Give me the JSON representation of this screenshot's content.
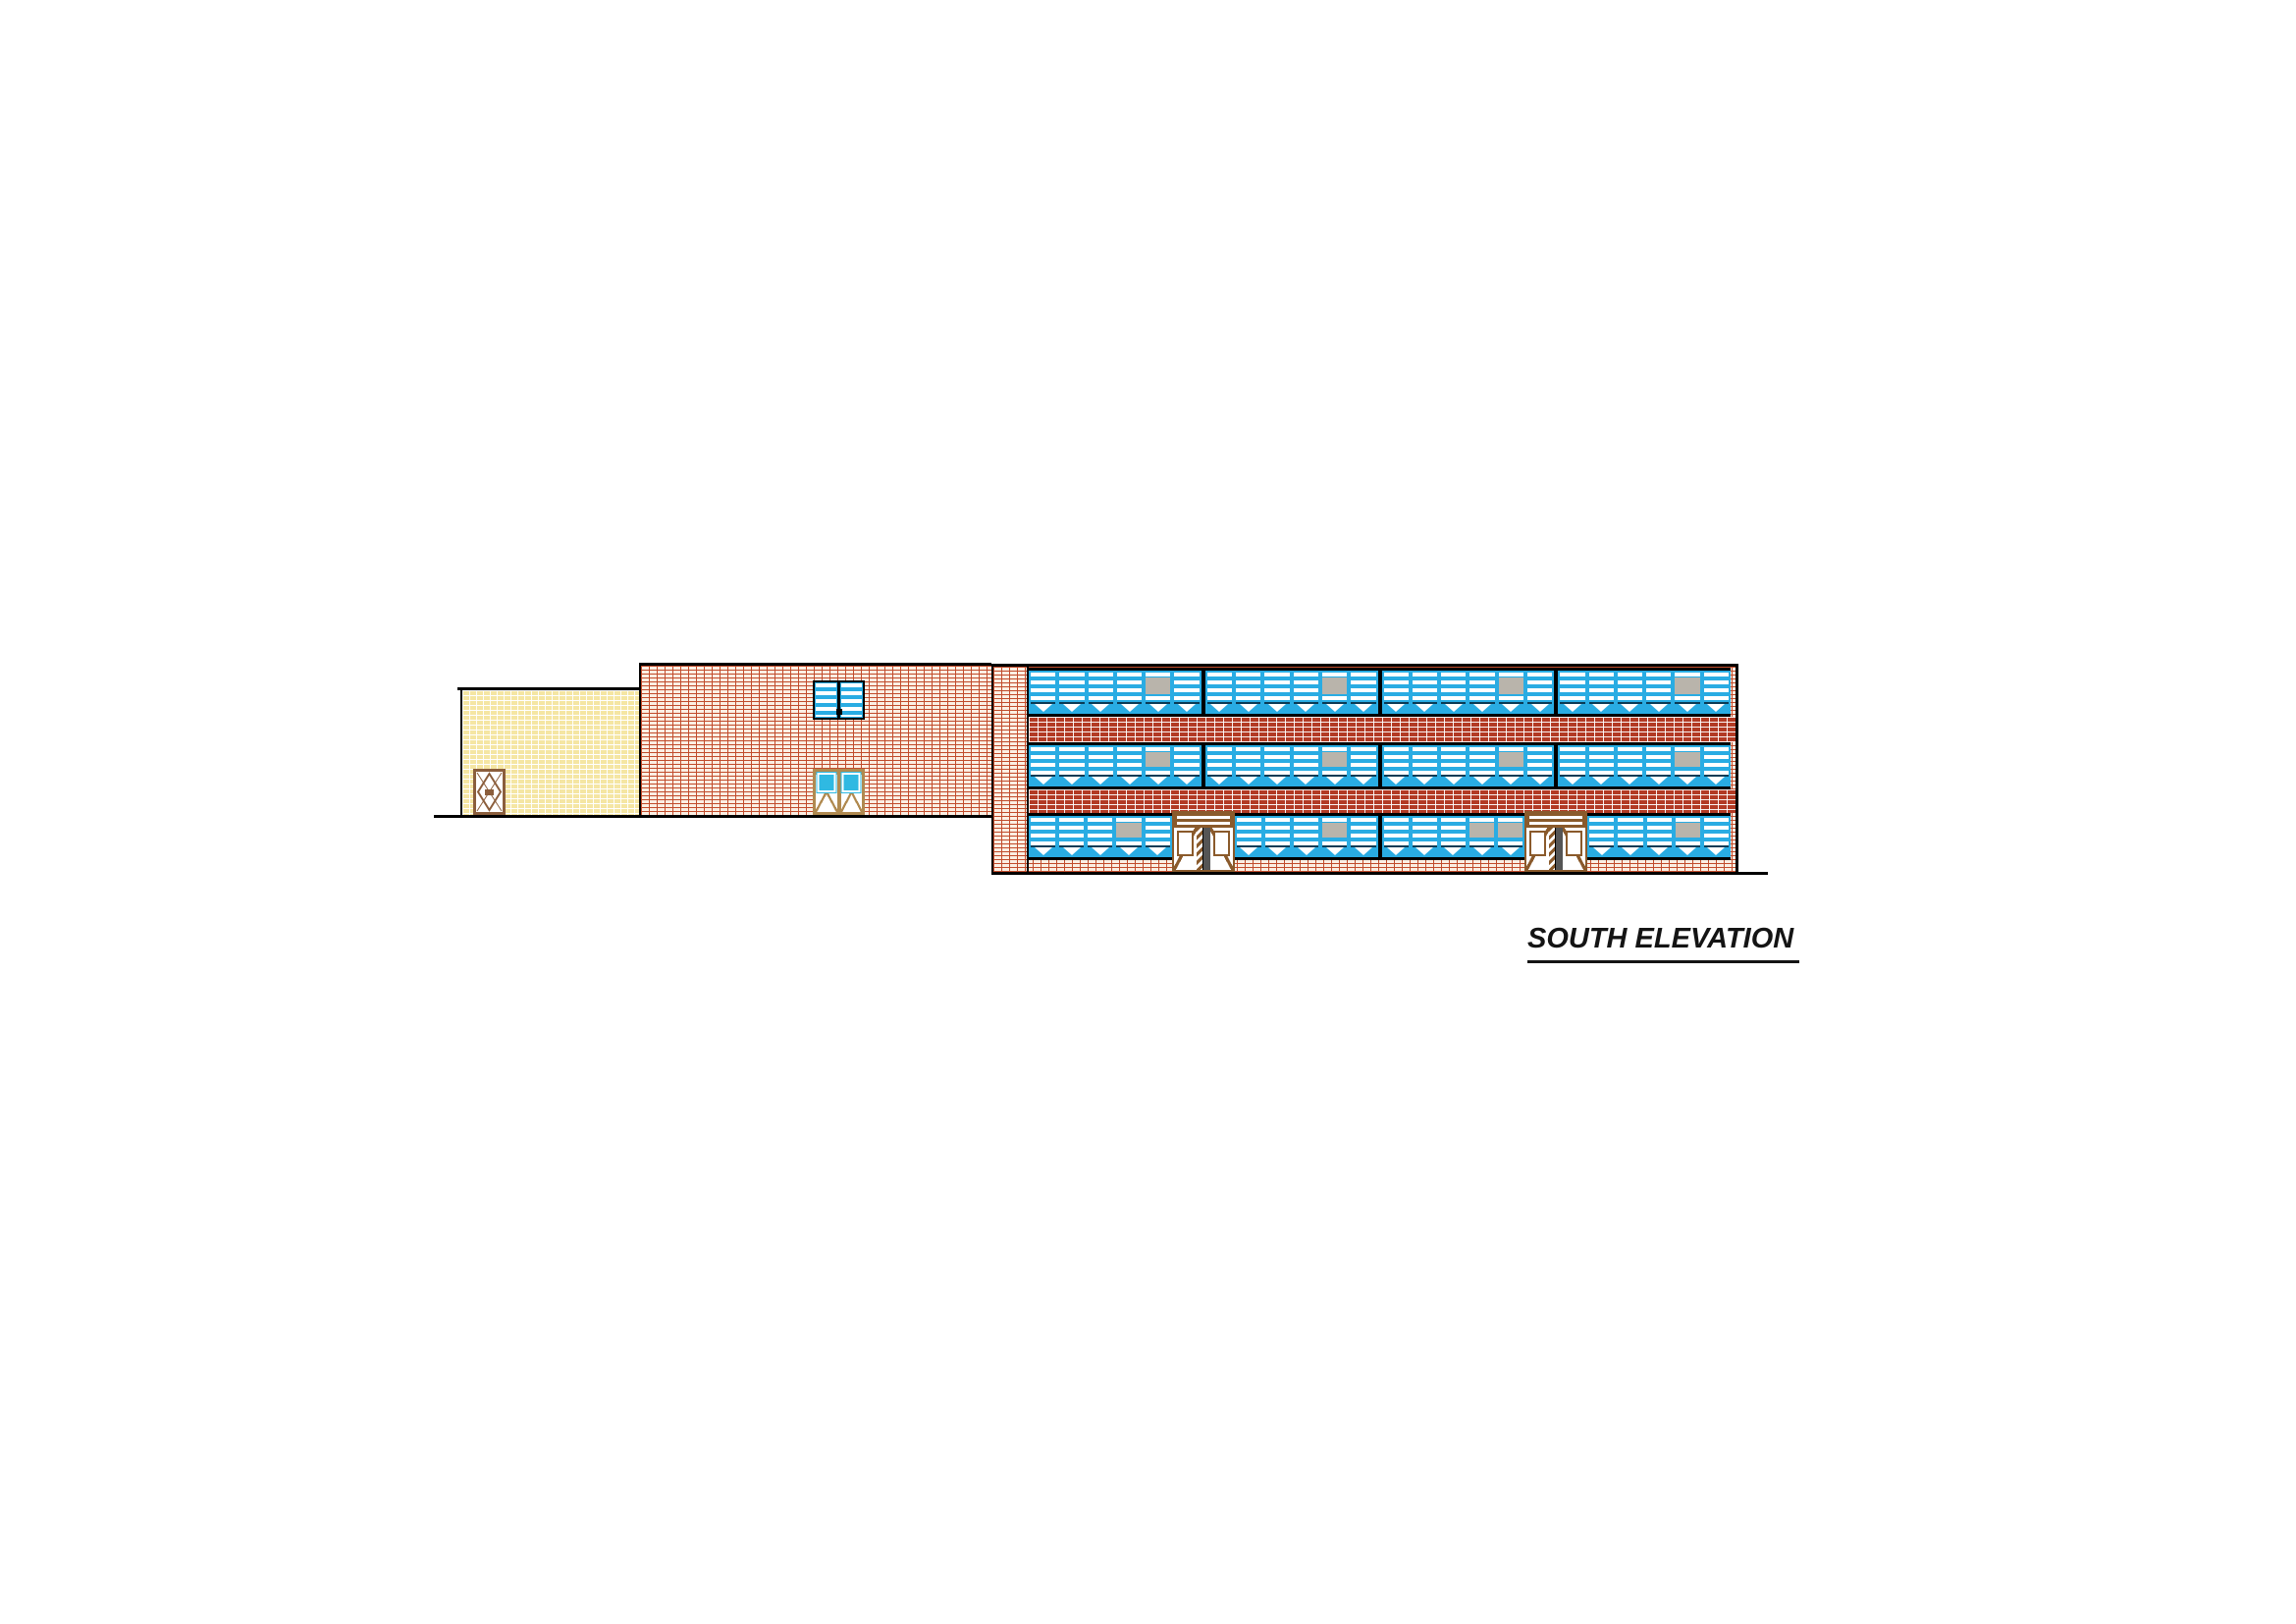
{
  "title_block": {
    "label": "SOUTH ELEVATION"
  },
  "colors": {
    "line_black": "#000000",
    "window_blue": "#29ACE3",
    "gray_panel": "#B9B4AB",
    "brick_line": "#C14C2C",
    "wall_bg": "#FBEFE3",
    "spandrel_red": "#B23A24",
    "cream_bg": "#F5E6A3",
    "door_brown": "#8A5A2B",
    "door_tan": "#B08A50",
    "door_teal": "#2FB9E2",
    "post_dark": "#555555"
  },
  "left_wing": {
    "description": "one-story cream brick wing",
    "door": {
      "style": "single door with diamond brace and knob"
    }
  },
  "center_wing": {
    "description": "two-story red brick gym wing",
    "window": {
      "panes": 2,
      "stripe_style": "horizontal louvers"
    },
    "door": {
      "style": "double door, glazed upper lights, diagonal braces"
    }
  },
  "main_block": {
    "description": "three-story classroom block with ribbon windows",
    "window_groups_per_floor": 4,
    "panes_per_group": 6,
    "floors": [
      {
        "name": "third-floor-windows",
        "segments": [
          {
            "t": "w",
            "n": 6,
            "gray": [
              5
            ]
          },
          {
            "t": "b"
          },
          {
            "t": "w",
            "n": 6,
            "gray": [
              5
            ]
          },
          {
            "t": "b"
          },
          {
            "t": "w",
            "n": 6,
            "gray": [
              5
            ]
          },
          {
            "t": "b"
          },
          {
            "t": "w",
            "n": 6,
            "gray": [
              5
            ]
          }
        ]
      },
      {
        "name": "second-floor-windows",
        "segments": [
          {
            "t": "w",
            "n": 6,
            "gray": [
              5
            ]
          },
          {
            "t": "b"
          },
          {
            "t": "w",
            "n": 6,
            "gray": [
              5
            ]
          },
          {
            "t": "b"
          },
          {
            "t": "w",
            "n": 6,
            "gray": [
              5
            ]
          },
          {
            "t": "b"
          },
          {
            "t": "w",
            "n": 6,
            "gray": [
              5
            ]
          }
        ]
      },
      {
        "name": "first-floor-windows",
        "segments": [
          {
            "t": "w",
            "n": 5,
            "gray": [
              4
            ]
          },
          {
            "t": "d"
          },
          {
            "t": "w",
            "n": 5,
            "gray": [
              4
            ]
          },
          {
            "t": "b"
          },
          {
            "t": "w",
            "n": 5,
            "gray": [
              4,
              5
            ]
          },
          {
            "t": "d"
          },
          {
            "t": "w",
            "n": 5,
            "gray": [
              4
            ]
          }
        ]
      }
    ],
    "entrance_doors": 2
  }
}
